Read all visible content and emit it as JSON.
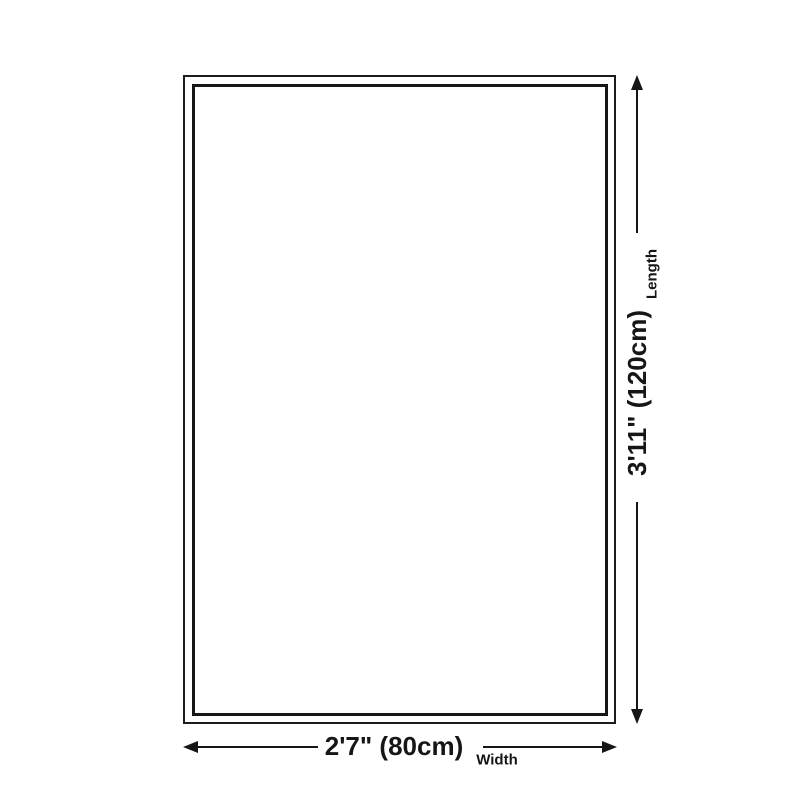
{
  "dimensions": {
    "length": {
      "value_label": "3'11\" (120cm)",
      "axis_label": "Length"
    },
    "width": {
      "value_label": "2'7\" (80cm)",
      "axis_label": "Width"
    }
  },
  "colors": {
    "line": "#161616",
    "background": "#ffffff"
  }
}
